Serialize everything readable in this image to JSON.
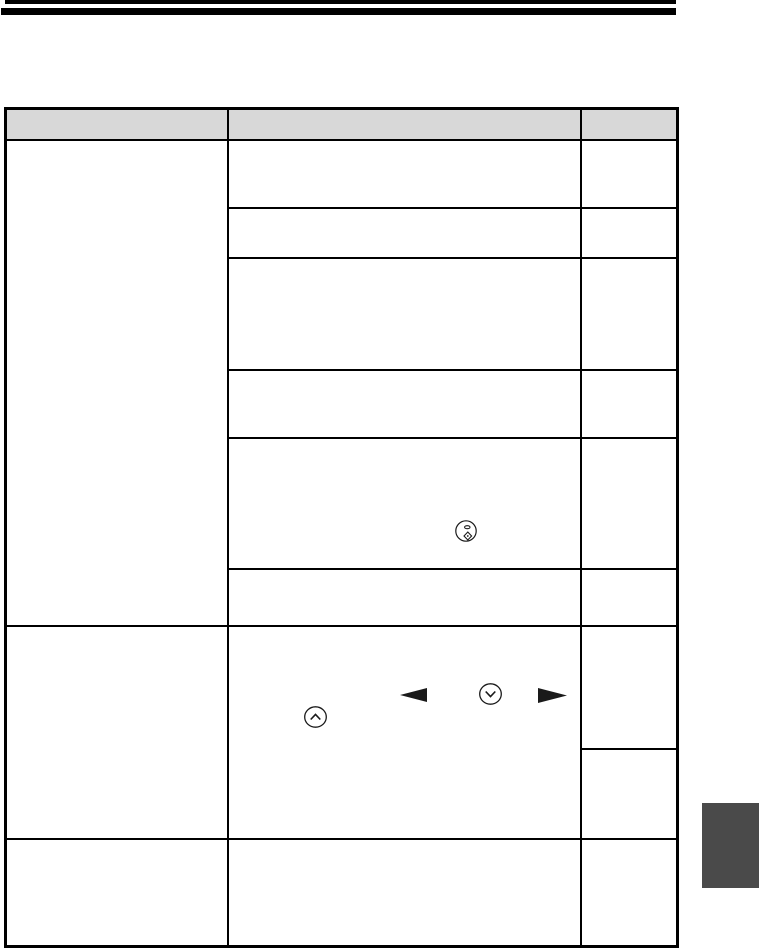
{
  "page": {
    "kind": "scanned-manual-table-page",
    "background": "#ffffff"
  },
  "top_rules": {
    "color": "#000000",
    "count": 2
  },
  "table": {
    "grid_color": "#000000",
    "header_fill": "#d8d8d8",
    "header": {
      "col1": "",
      "col2": "",
      "col3": ""
    },
    "col1_cells": [
      "",
      "",
      ""
    ],
    "col2_cells": [
      "",
      "",
      "",
      "",
      "",
      "",
      "",
      ""
    ],
    "col3_cells": [
      "",
      "",
      "",
      "",
      "",
      "",
      "",
      "",
      ""
    ]
  },
  "icons": {
    "diamond_button": "circled-diamond-button",
    "up_button": "circled-chevron-up-button",
    "down_button": "circled-chevron-down-button",
    "left_arrow": "solid-left-triangle",
    "right_arrow": "solid-right-triangle",
    "stroke_color": "#1a1a1a"
  },
  "side_tab": {
    "color": "#4a4a4a"
  }
}
